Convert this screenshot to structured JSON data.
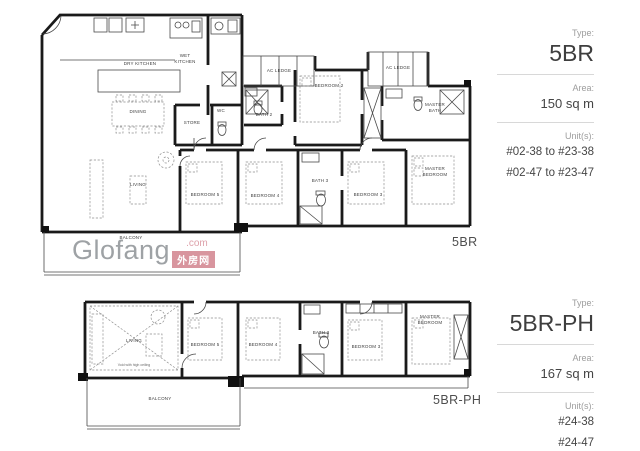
{
  "watermark": {
    "brand": "Glofang",
    "dotcom": ".com",
    "badge": "外房网"
  },
  "plan1": {
    "caption": "5BR",
    "rooms": {
      "dry_kitchen": "DRY KITCHEN",
      "wet_kitchen": "WET KITCHEN",
      "dining": "DINING",
      "store": "STORE",
      "wc": "WC",
      "bath2": "BATH 2",
      "bedroom2": "BEDROOM 2",
      "ac_ledge_a": "AC LEDGE",
      "ac_ledge_b": "AC LEDGE",
      "master_bath": "MASTER BATH",
      "living": "LIVING",
      "bedroom5": "BEDROOM 5",
      "bedroom4": "BEDROOM 4",
      "bath3": "BATH 3",
      "bedroom3": "BEDROOM 3",
      "master_bedroom": "MASTER BEDROOM",
      "balcony": "BALCONY"
    }
  },
  "plan2": {
    "caption": "5BR-PH",
    "rooms": {
      "living": "LIVING",
      "living_note": "Void with high ceiling",
      "bedroom5": "BEDROOM 5",
      "bedroom4": "BEDROOM 4",
      "bath3": "BATH 3",
      "bedroom3": "BEDROOM 3",
      "master_bedroom": "MASTER BEDROOM",
      "balcony": "BALCONY"
    }
  },
  "panel1": {
    "type_label": "Type:",
    "type_value": "5BR",
    "area_label": "Area:",
    "area_value": "150 sq m",
    "units_label": "Unit(s):",
    "units": [
      "#02-38 to #23-38",
      "#02-47 to #23-47"
    ]
  },
  "panel2": {
    "type_label": "Type:",
    "type_value": "5BR-PH",
    "area_label": "Area:",
    "area_value": "167 sq m",
    "units_label": "Unit(s):",
    "units": [
      "#24-38",
      "#24-47"
    ]
  }
}
